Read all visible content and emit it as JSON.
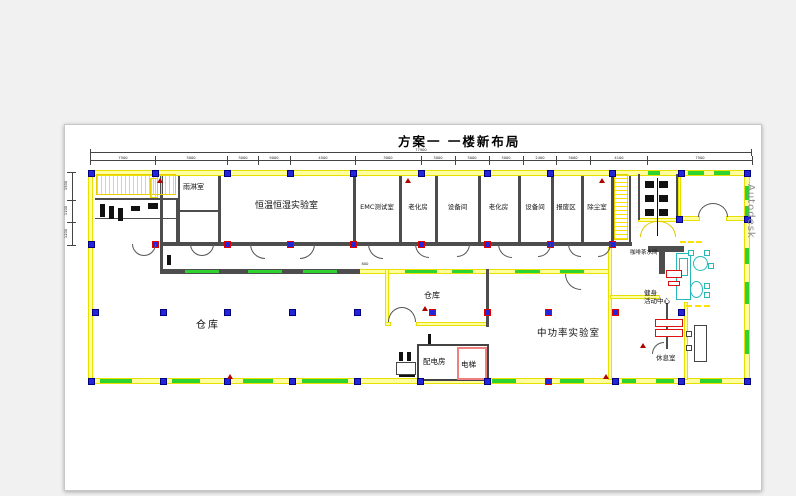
{
  "title": "方案一  一楼新布局",
  "watermark": "Autodesk",
  "rooms": {
    "rain": "雨淋室",
    "humidity_lab": "恒温恒湿实验室",
    "emc_lab": "EMC测试室",
    "aging_1": "老化房",
    "equipment_1": "设备间",
    "aging_2": "老化房",
    "equipment_2": "设备间",
    "scrap_area": "报废区",
    "dust_room": "除尘室",
    "warehouse_main": "仓库",
    "warehouse_small": "仓库",
    "mid_power_lab": "中功率实验室",
    "power_distribution": "配电房",
    "elevator": "电梯",
    "coffee_pantry": "咖啡茶水间",
    "fitness_center": "健身\n活动中心",
    "rest_room": "休息室"
  },
  "dimensions": {
    "overall": "77900",
    "top": [
      "7500",
      "3000",
      "3000",
      "9000",
      "4500",
      "3000",
      "3000",
      "3000",
      "3000",
      "2400",
      "3000",
      "4100",
      "7500"
    ],
    "left": [
      "1500",
      "1100",
      "1200"
    ],
    "misc": "800"
  },
  "colors": {
    "wall": "#e8e000",
    "window": "#2fd32f",
    "column": "#2424d8",
    "alert": "#dd1111",
    "furniture": "#27b8b8",
    "background": "#f0f1f0",
    "canvas": "#ffffff"
  }
}
